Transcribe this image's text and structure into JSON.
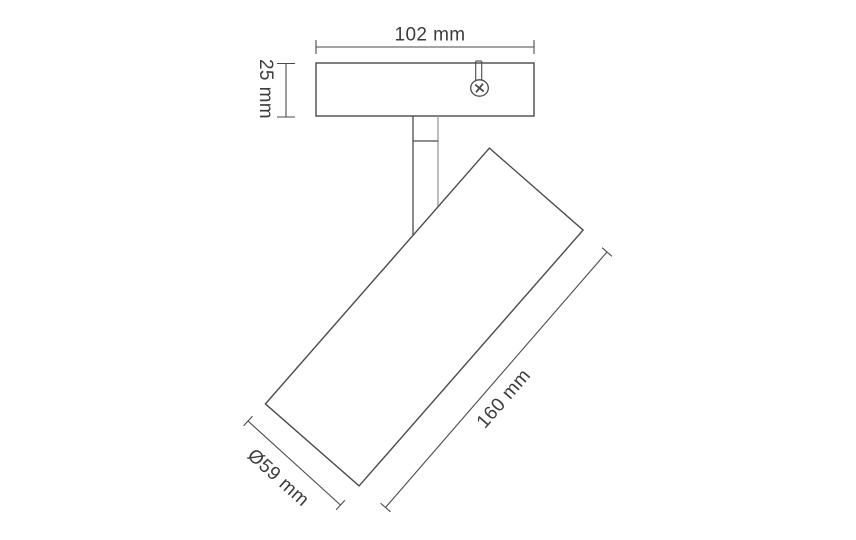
{
  "drawing": {
    "dimensions": {
      "plate_width": "102 mm",
      "plate_height": "25 mm",
      "body_length": "160 mm",
      "body_diameter": "Ø59 mm"
    },
    "colors": {
      "line": "#4a4a4a",
      "line_light": "#9b9b9b",
      "text": "#3c3c3c",
      "background": "#ffffff"
    }
  }
}
